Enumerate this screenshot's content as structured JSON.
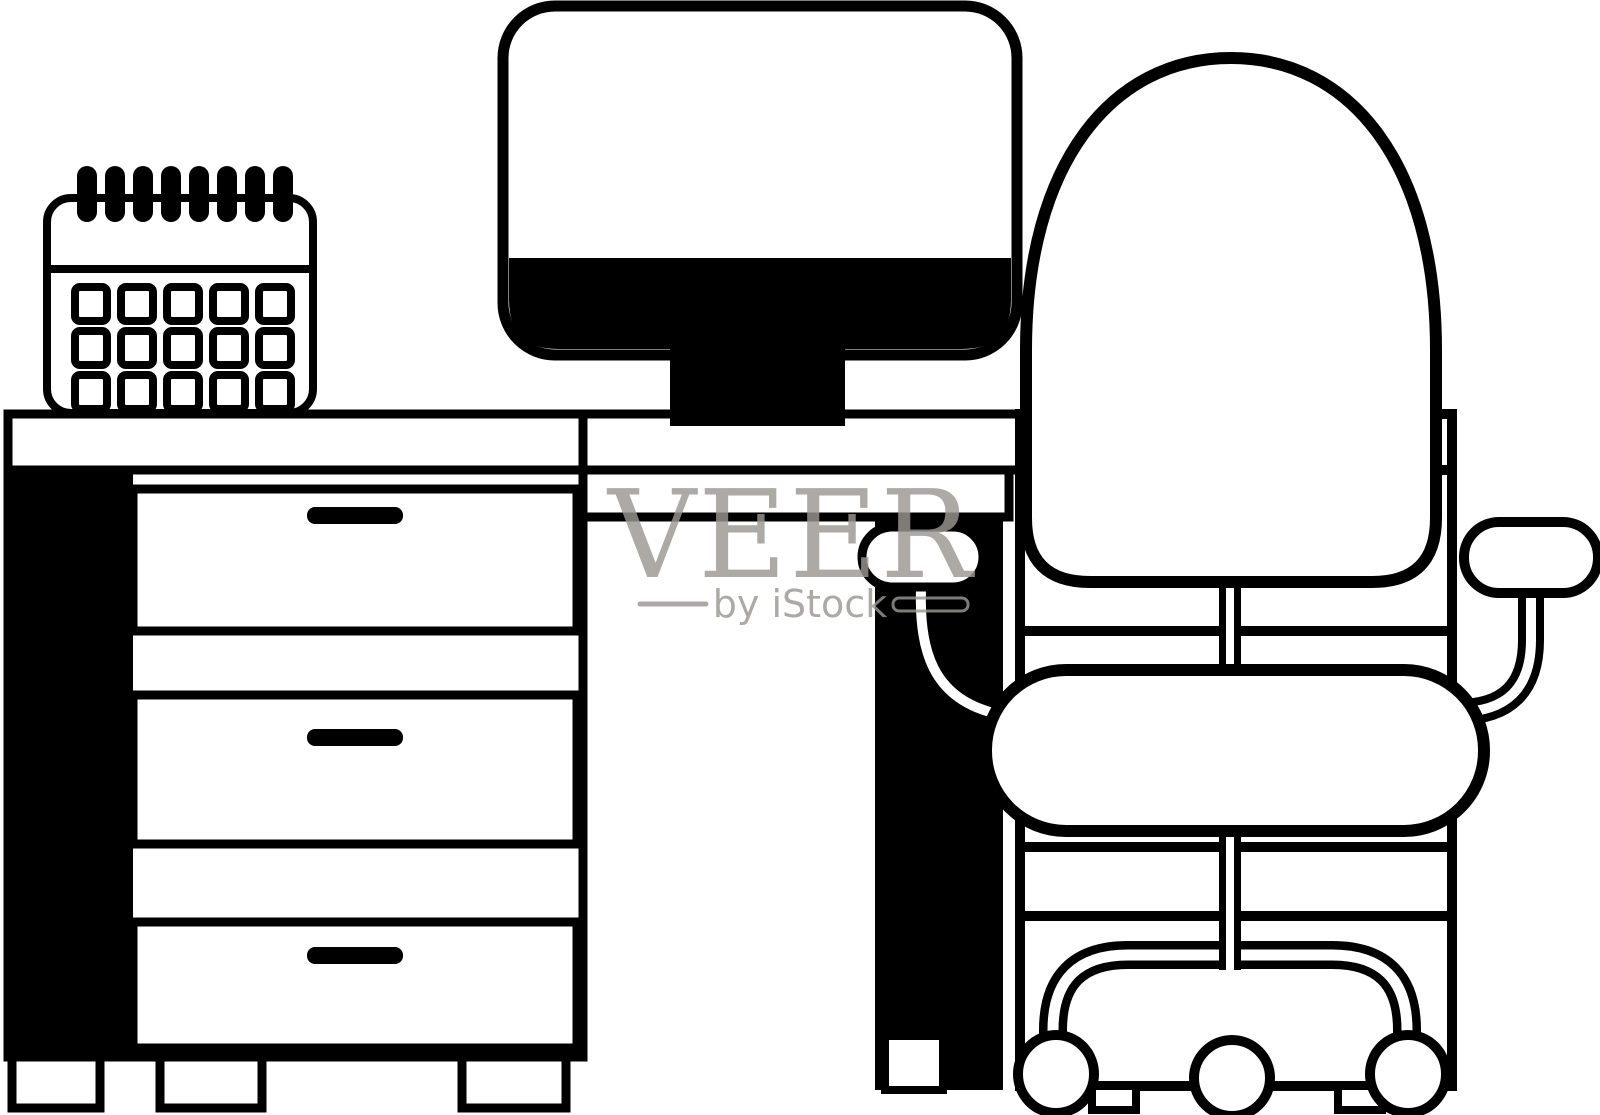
{
  "illustration": {
    "description": "Black and white line-art illustration of an office workspace: a desk with two drawer pedestals, a desktop computer monitor, a spiral desk calendar, and an office swivel chair with casters",
    "background_color": "#ffffff",
    "ink_color": "#000000",
    "objects": [
      {
        "name": "calendar-icon",
        "detail": "spiral-bound desk calendar, 8 binder rings, 5x3 day grid"
      },
      {
        "name": "computer-monitor-icon",
        "detail": "monitor with dark lower bezel band and pedestal stand"
      },
      {
        "name": "desk-icon",
        "detail": "desk with left pedestal of 3 drawers with handles, middle apron, right pedestal, plinth feet"
      },
      {
        "name": "office-chair-icon",
        "detail": "swivel chair with dome backrest, seat cushion, two armrests, center column, arched base on 3 casters"
      }
    ]
  },
  "watermark": {
    "brand": "VEER",
    "byline": "by iStock",
    "color": "#9c9893"
  }
}
